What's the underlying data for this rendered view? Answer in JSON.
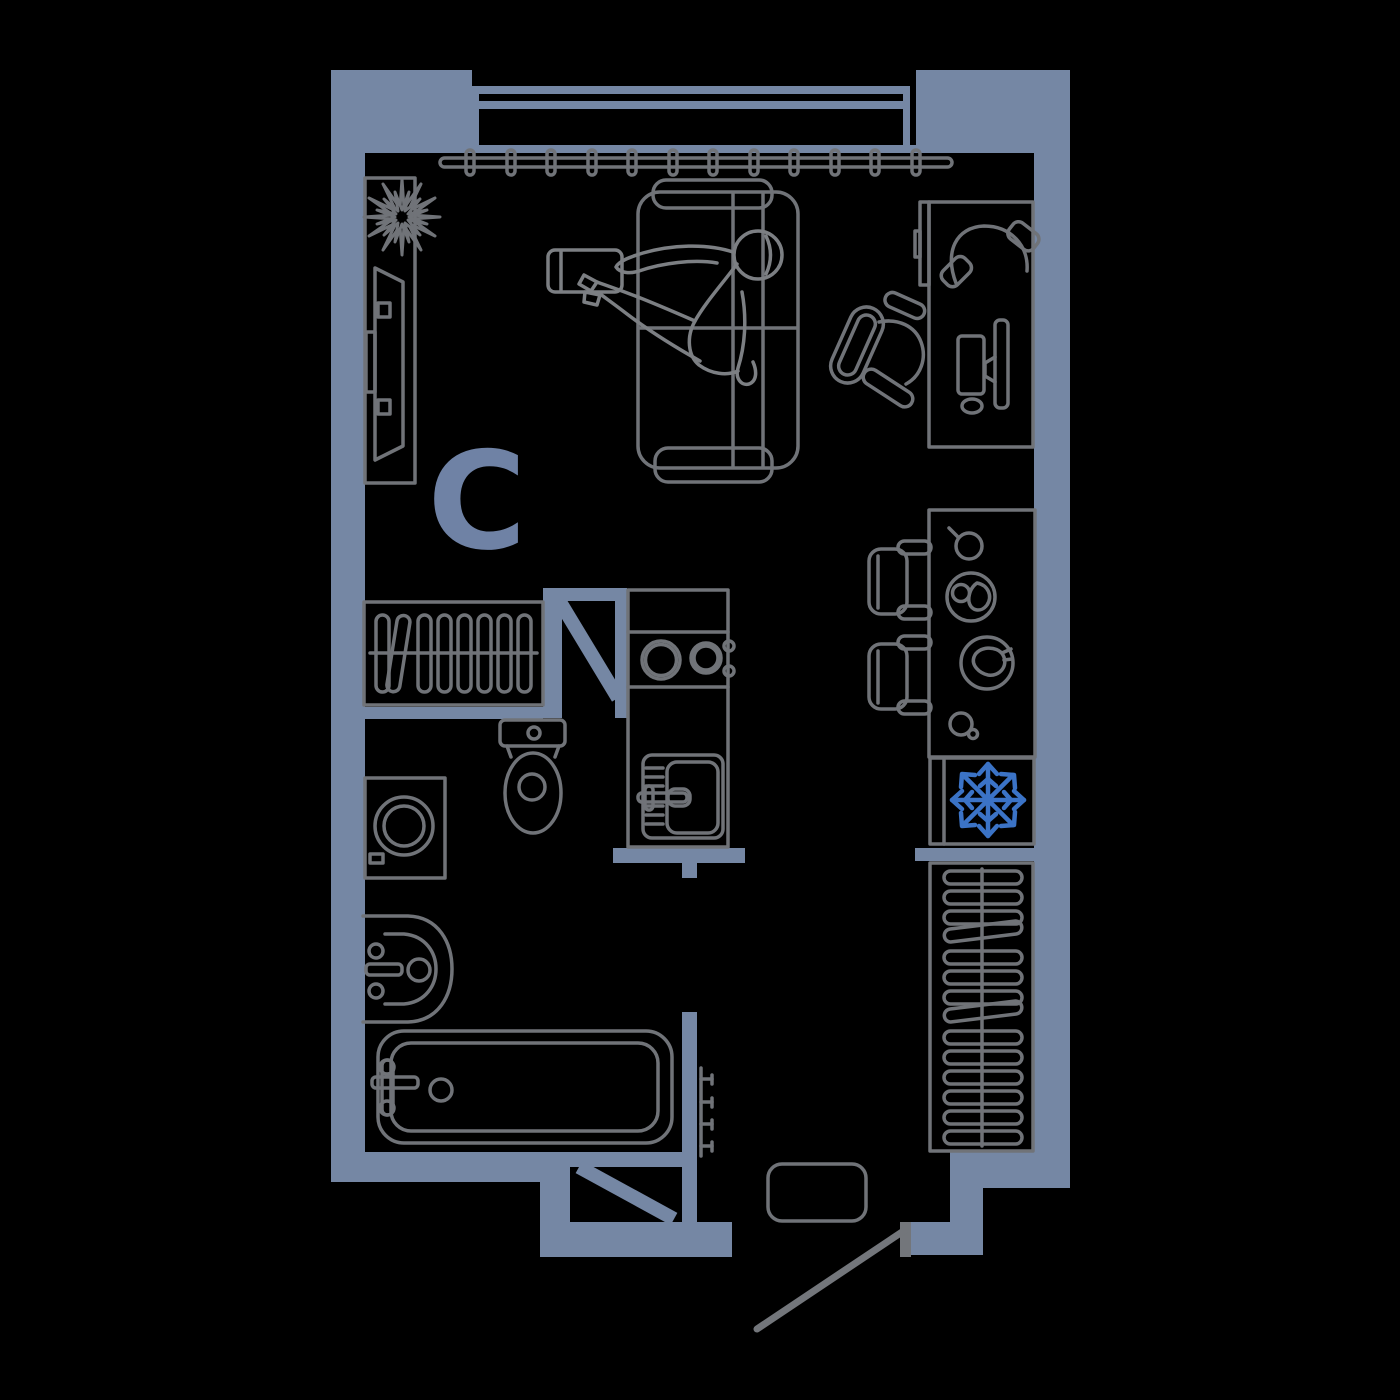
{
  "unit_label": "C",
  "colors": {
    "background": "#000000",
    "wall": "#7587A4",
    "unit_label": "#6F82A5",
    "snowflake_blue": "#3B73C6",
    "furniture_line": "#707378",
    "person_line": "#7C7F83",
    "entry_door": "#73767B"
  },
  "furniture": {
    "living_room": [
      "curtain-rail",
      "plant",
      "tv-console",
      "wall-tv",
      "sofa-bed",
      "person-lying",
      "laptop",
      "desk",
      "monitor",
      "keyboard",
      "mouse",
      "headphones",
      "office-chair"
    ],
    "kitchen": [
      "kitchen-counter",
      "stove-burners",
      "kitchen-sink",
      "dining-table",
      "dining-chair",
      "dining-chair",
      "cup",
      "breakfast-plate",
      "dinner-plate",
      "glass",
      "refrigerator",
      "snowflake-icon"
    ],
    "bathroom": [
      "toilet",
      "washing-machine",
      "wash-basin",
      "bathtub",
      "towel-radiator"
    ],
    "hall": [
      "wardrobe-left",
      "wardrobe-right",
      "doormat",
      "entry-door",
      "bathroom-door",
      "wc-door"
    ]
  }
}
